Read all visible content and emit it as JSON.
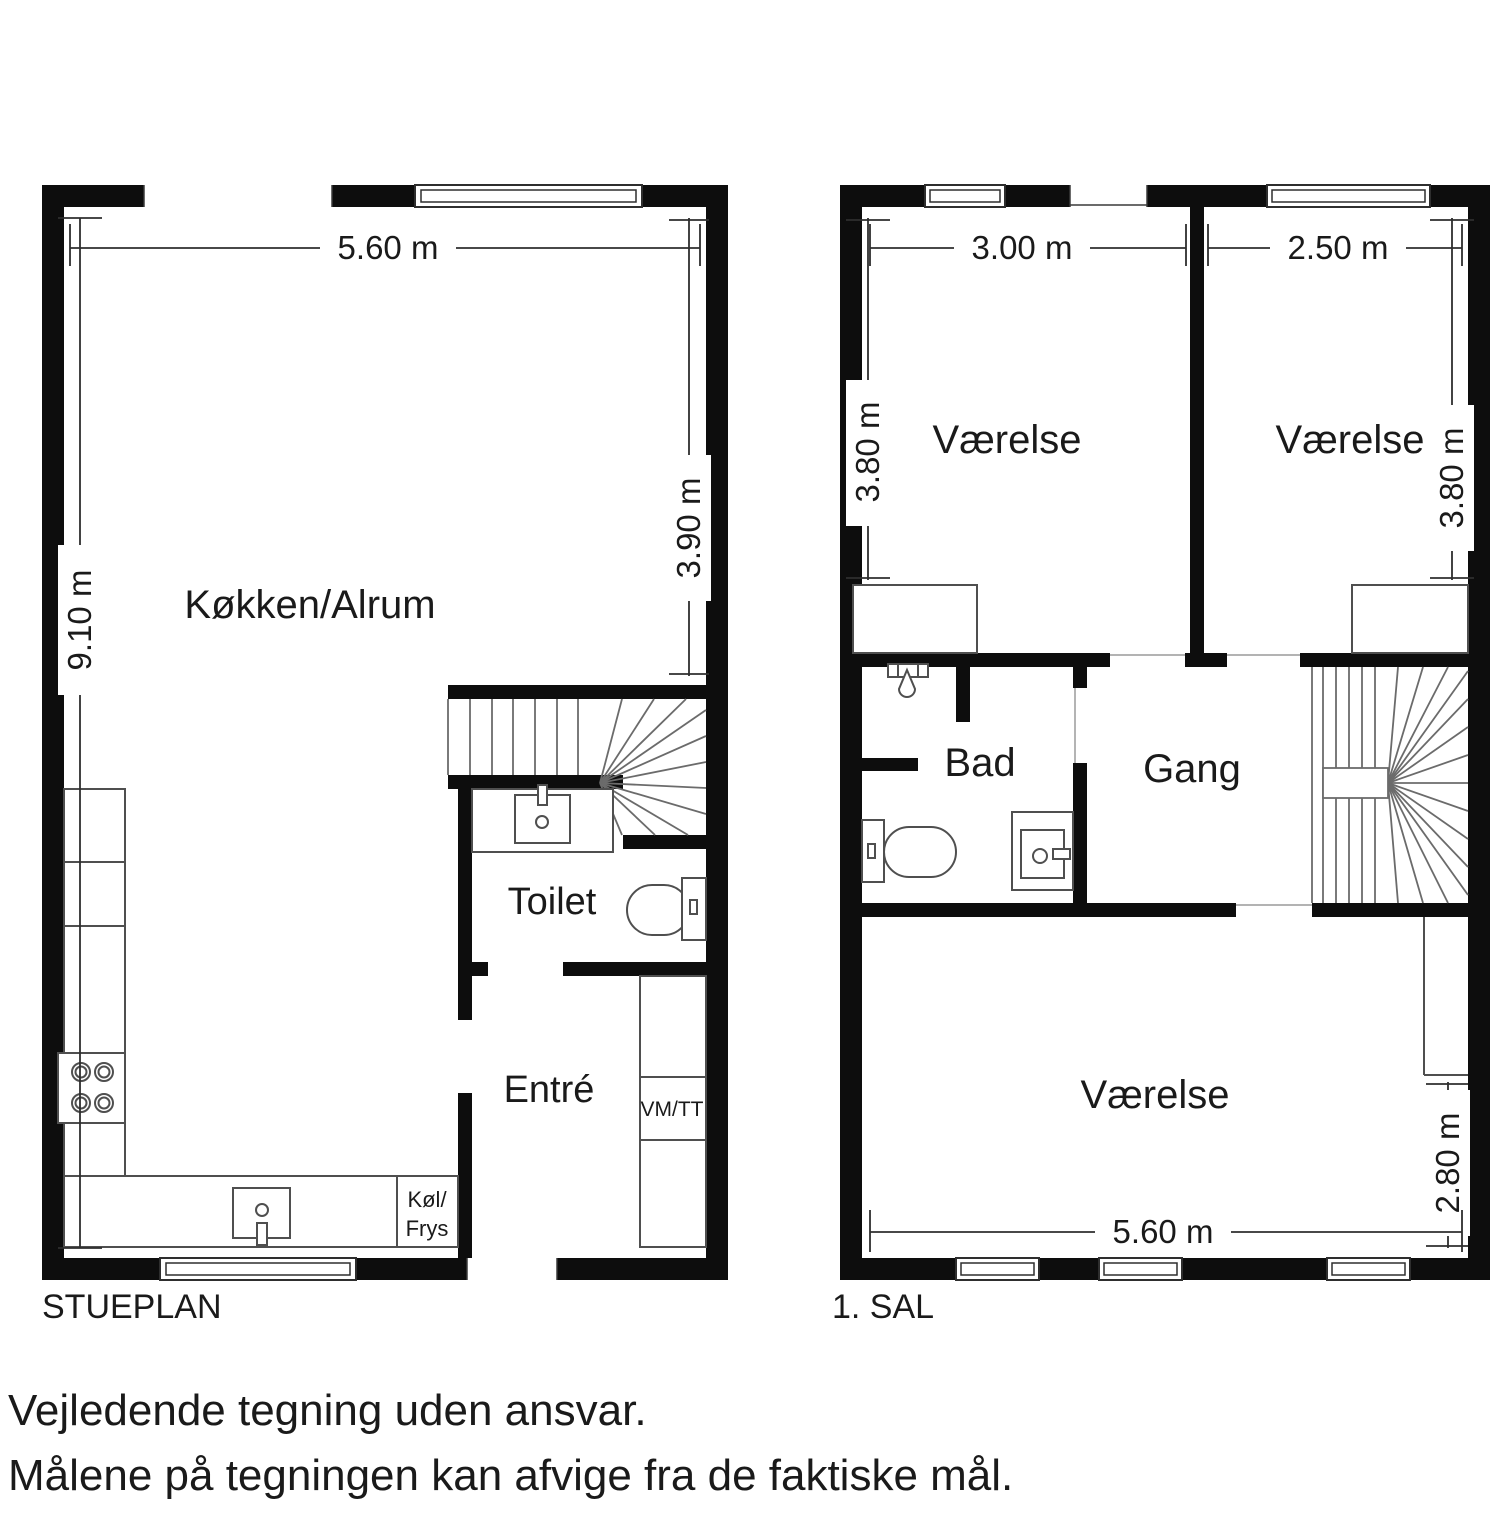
{
  "colors": {
    "background": "#ffffff",
    "wall": "#0d0d0d",
    "fixture_outline": "#4f4f4f",
    "stair_line": "#6b6b6b",
    "dimension_line": "#2e2e2e",
    "text": "#1a1a1a"
  },
  "floors": {
    "stueplan": {
      "label": "STUEPLAN",
      "rooms": {
        "kitchen": "Køkken/Alrum",
        "toilet": "Toilet",
        "entry": "Entré"
      },
      "appliances": {
        "washer_dryer": "VM/TT",
        "fridge_line1": "Køl/",
        "fridge_line2": "Frys"
      },
      "dimensions": {
        "width_top": "5.60 m",
        "height_left": "9.10 m",
        "height_right": "3.90 m"
      }
    },
    "first_floor": {
      "label": "1. SAL",
      "rooms": {
        "bedroom_left": "Værelse",
        "bedroom_right": "Værelse",
        "bedroom_bottom": "Værelse",
        "bathroom": "Bad",
        "hallway": "Gang"
      },
      "dimensions": {
        "bedroom_left_width": "3.00 m",
        "bedroom_right_width": "2.50 m",
        "bedroom_left_height": "3.80 m",
        "bedroom_right_height": "3.80 m",
        "bedroom_bottom_height": "2.80 m",
        "bedroom_bottom_width": "5.60 m"
      }
    }
  },
  "disclaimer": {
    "line1": "Vejledende tegning uden ansvar.",
    "line2": "Målene på tegningen kan afvige fra de faktiske mål."
  }
}
